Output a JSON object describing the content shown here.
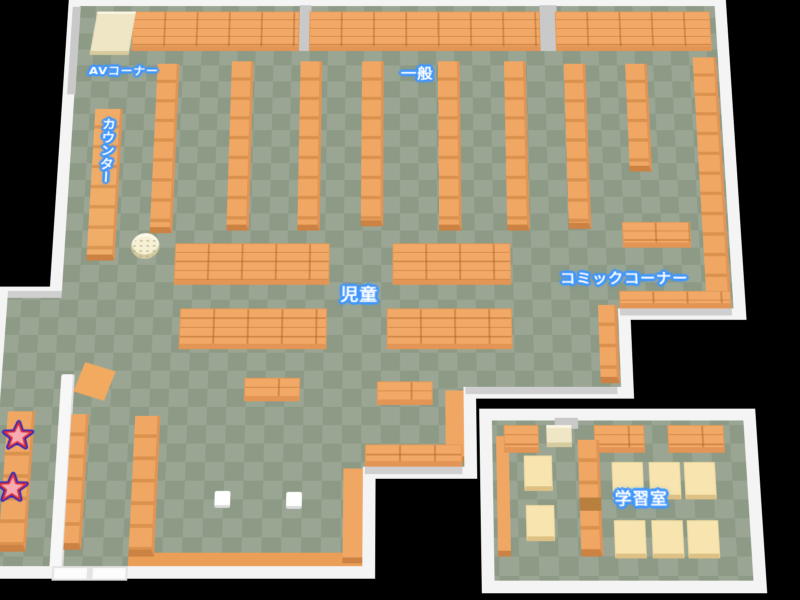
{
  "map_labels": {
    "av_corner": "AVコーナー",
    "general": "一般",
    "counter": "カウンター",
    "children": "児童",
    "comic_corner": "コミックコーナー",
    "study_room": "学習室"
  },
  "markers": {
    "star_count": 2,
    "star_description": "red star markers with blue outline on left wall shelf"
  },
  "colors": {
    "background": "#000000",
    "floor_light": "#9aa693",
    "floor_dark": "#8c9a86",
    "wall": "#f4f4f4",
    "wall_shade": "#cfcfcf",
    "shelf_orange": "#f0a763",
    "shelf_front": "#cb8242",
    "table_cream": "#f7e4ae",
    "av_shelf_cream": "#eee6c4",
    "label_text": "#ffffff",
    "label_outline": "#3f96ff",
    "star_fill": "#f8aab2",
    "star_stroke": "#d83038",
    "star_outline": "#2323cc"
  }
}
